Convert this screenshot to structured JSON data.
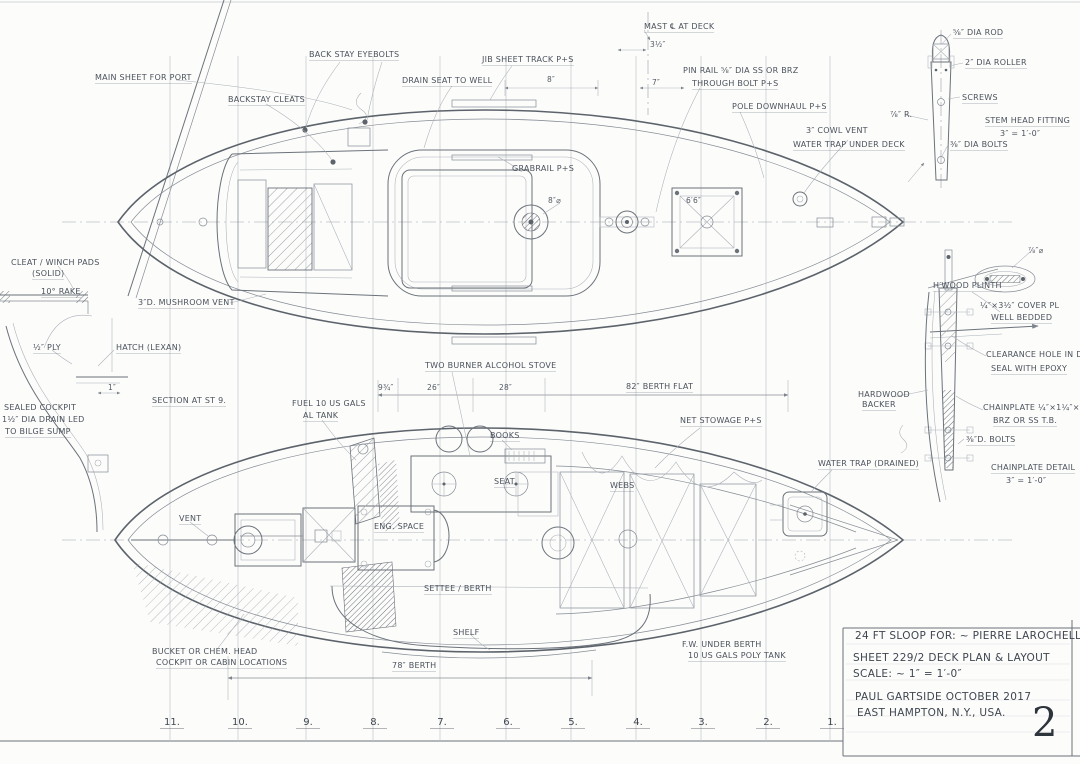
{
  "sheet": {
    "page_number": "2"
  },
  "title_block": {
    "line1": "24 FT SLOOP FOR: ~ PIERRE LAROCHELLE",
    "line2": "SHEET 229/2  DECK PLAN & LAYOUT",
    "line3": "SCALE: ~ 1″ = 1′-0″",
    "line4": "PAUL GARTSIDE   OCTOBER 2017",
    "line5": "EAST HAMPTON, N.Y.,  USA."
  },
  "stations": [
    "11.",
    "10.",
    "9.",
    "8.",
    "7.",
    "6.",
    "5.",
    "4.",
    "3.",
    "2.",
    "1."
  ],
  "deck_plan": {
    "main_sheet": "MAIN SHEET FOR PORT",
    "backstay_eyebolts": "BACK STAY EYEBOLTS",
    "backstay_cleats": "BACKSTAY CLEATS",
    "jib_sheet_track": "JIB SHEET TRACK P+S",
    "drain_seat": "DRAIN SEAT TO WELL",
    "mast_at_deck": "MAST ℄ AT DECK",
    "pin_rail_line1": "PIN RAIL ⅝″ DIA SS OR BRZ",
    "pin_rail_line2": "THROUGH BOLT P+S",
    "pole_downhaul": "POLE DOWNHAUL P+S",
    "cowl_vent_line1": "3″ COWL VENT",
    "cowl_vent_line2": "WATER TRAP UNDER DECK",
    "grabrail": "GRABRAIL P+S",
    "wheel_dia": "8″⌀",
    "hatch_dim": "6′6″",
    "mushroom_vent": "3″D. MUSHROOM VENT"
  },
  "deck_dims": {
    "d35": "3½″",
    "d7": "7″",
    "d8": "8″"
  },
  "stem_head_detail": {
    "rod": "⅝″ DIA ROD",
    "roller": "2″ DIA ROLLER",
    "screws": "SCREWS",
    "radius": "⅞″ R.",
    "bolts": "⅜″ DIA BOLTS",
    "title": "STEM HEAD FITTING",
    "scale": "3″ = 1′-0″"
  },
  "chainplate_detail": {
    "dia": "⅞″⌀",
    "plinth": "H′WOOD PLINTH",
    "cover_line1": "¼″×3½″ COVER PL",
    "cover_line2": "WELL BEDDED",
    "clearance_line1": "CLEARANCE HOLE IN DECK",
    "clearance_line2": "SEAL WITH EPOXY",
    "plate_line1": "CHAINPLATE ¼″×1¼″×16″",
    "plate_line2": "BRZ OR SS T.B.",
    "bolts": "⅜″D. BOLTS",
    "backer_line1": "HARDWOOD",
    "backer_line2": "BACKER",
    "title": "CHAINPLATE DETAIL",
    "scale": "3″ = 1′-0″"
  },
  "section_detail": {
    "cleat_line1": "CLEAT / WINCH PADS",
    "cleat_line2": "(SOLID)",
    "rake": "10° RAKE",
    "ply": "½″ PLY",
    "hatch": "HATCH (LEXAN)",
    "dim_one_inch": "1″",
    "cockpit_line1": "SEALED COCKPIT",
    "cockpit_line2": "1½″ DIA DRAIN LED",
    "cockpit_line3": "TO BILGE SUMP",
    "title": "SECTION AT ST 9."
  },
  "layout_plan": {
    "stove": "TWO BURNER ALCOHOL STOVE",
    "fuel_line1": "FUEL 10 US GALS",
    "fuel_line2": "AL TANK",
    "books": "BOOKS",
    "seat": "SEAT",
    "net_stowage": "NET STOWAGE P+S",
    "webs": "WEBS",
    "water_trap": "WATER TRAP (DRAINED)",
    "vent": "VENT",
    "engine_space": "ENG. SPACE",
    "settee": "SETTEE / BERTH",
    "shelf": "SHELF",
    "head_line1": "BUCKET OR CHEM. HEAD",
    "head_line2": "COCKPIT OR CABIN LOCATIONS",
    "fresh_water_line1": "F.W. UNDER BERTH",
    "fresh_water_line2": "10 US GALS POLY TANK"
  },
  "layout_dims": {
    "d975": "9¾″",
    "d26": "26″",
    "d28": "28″",
    "berth_flat": "82″ BERTH FLAT",
    "berth": "78″ BERTH"
  }
}
